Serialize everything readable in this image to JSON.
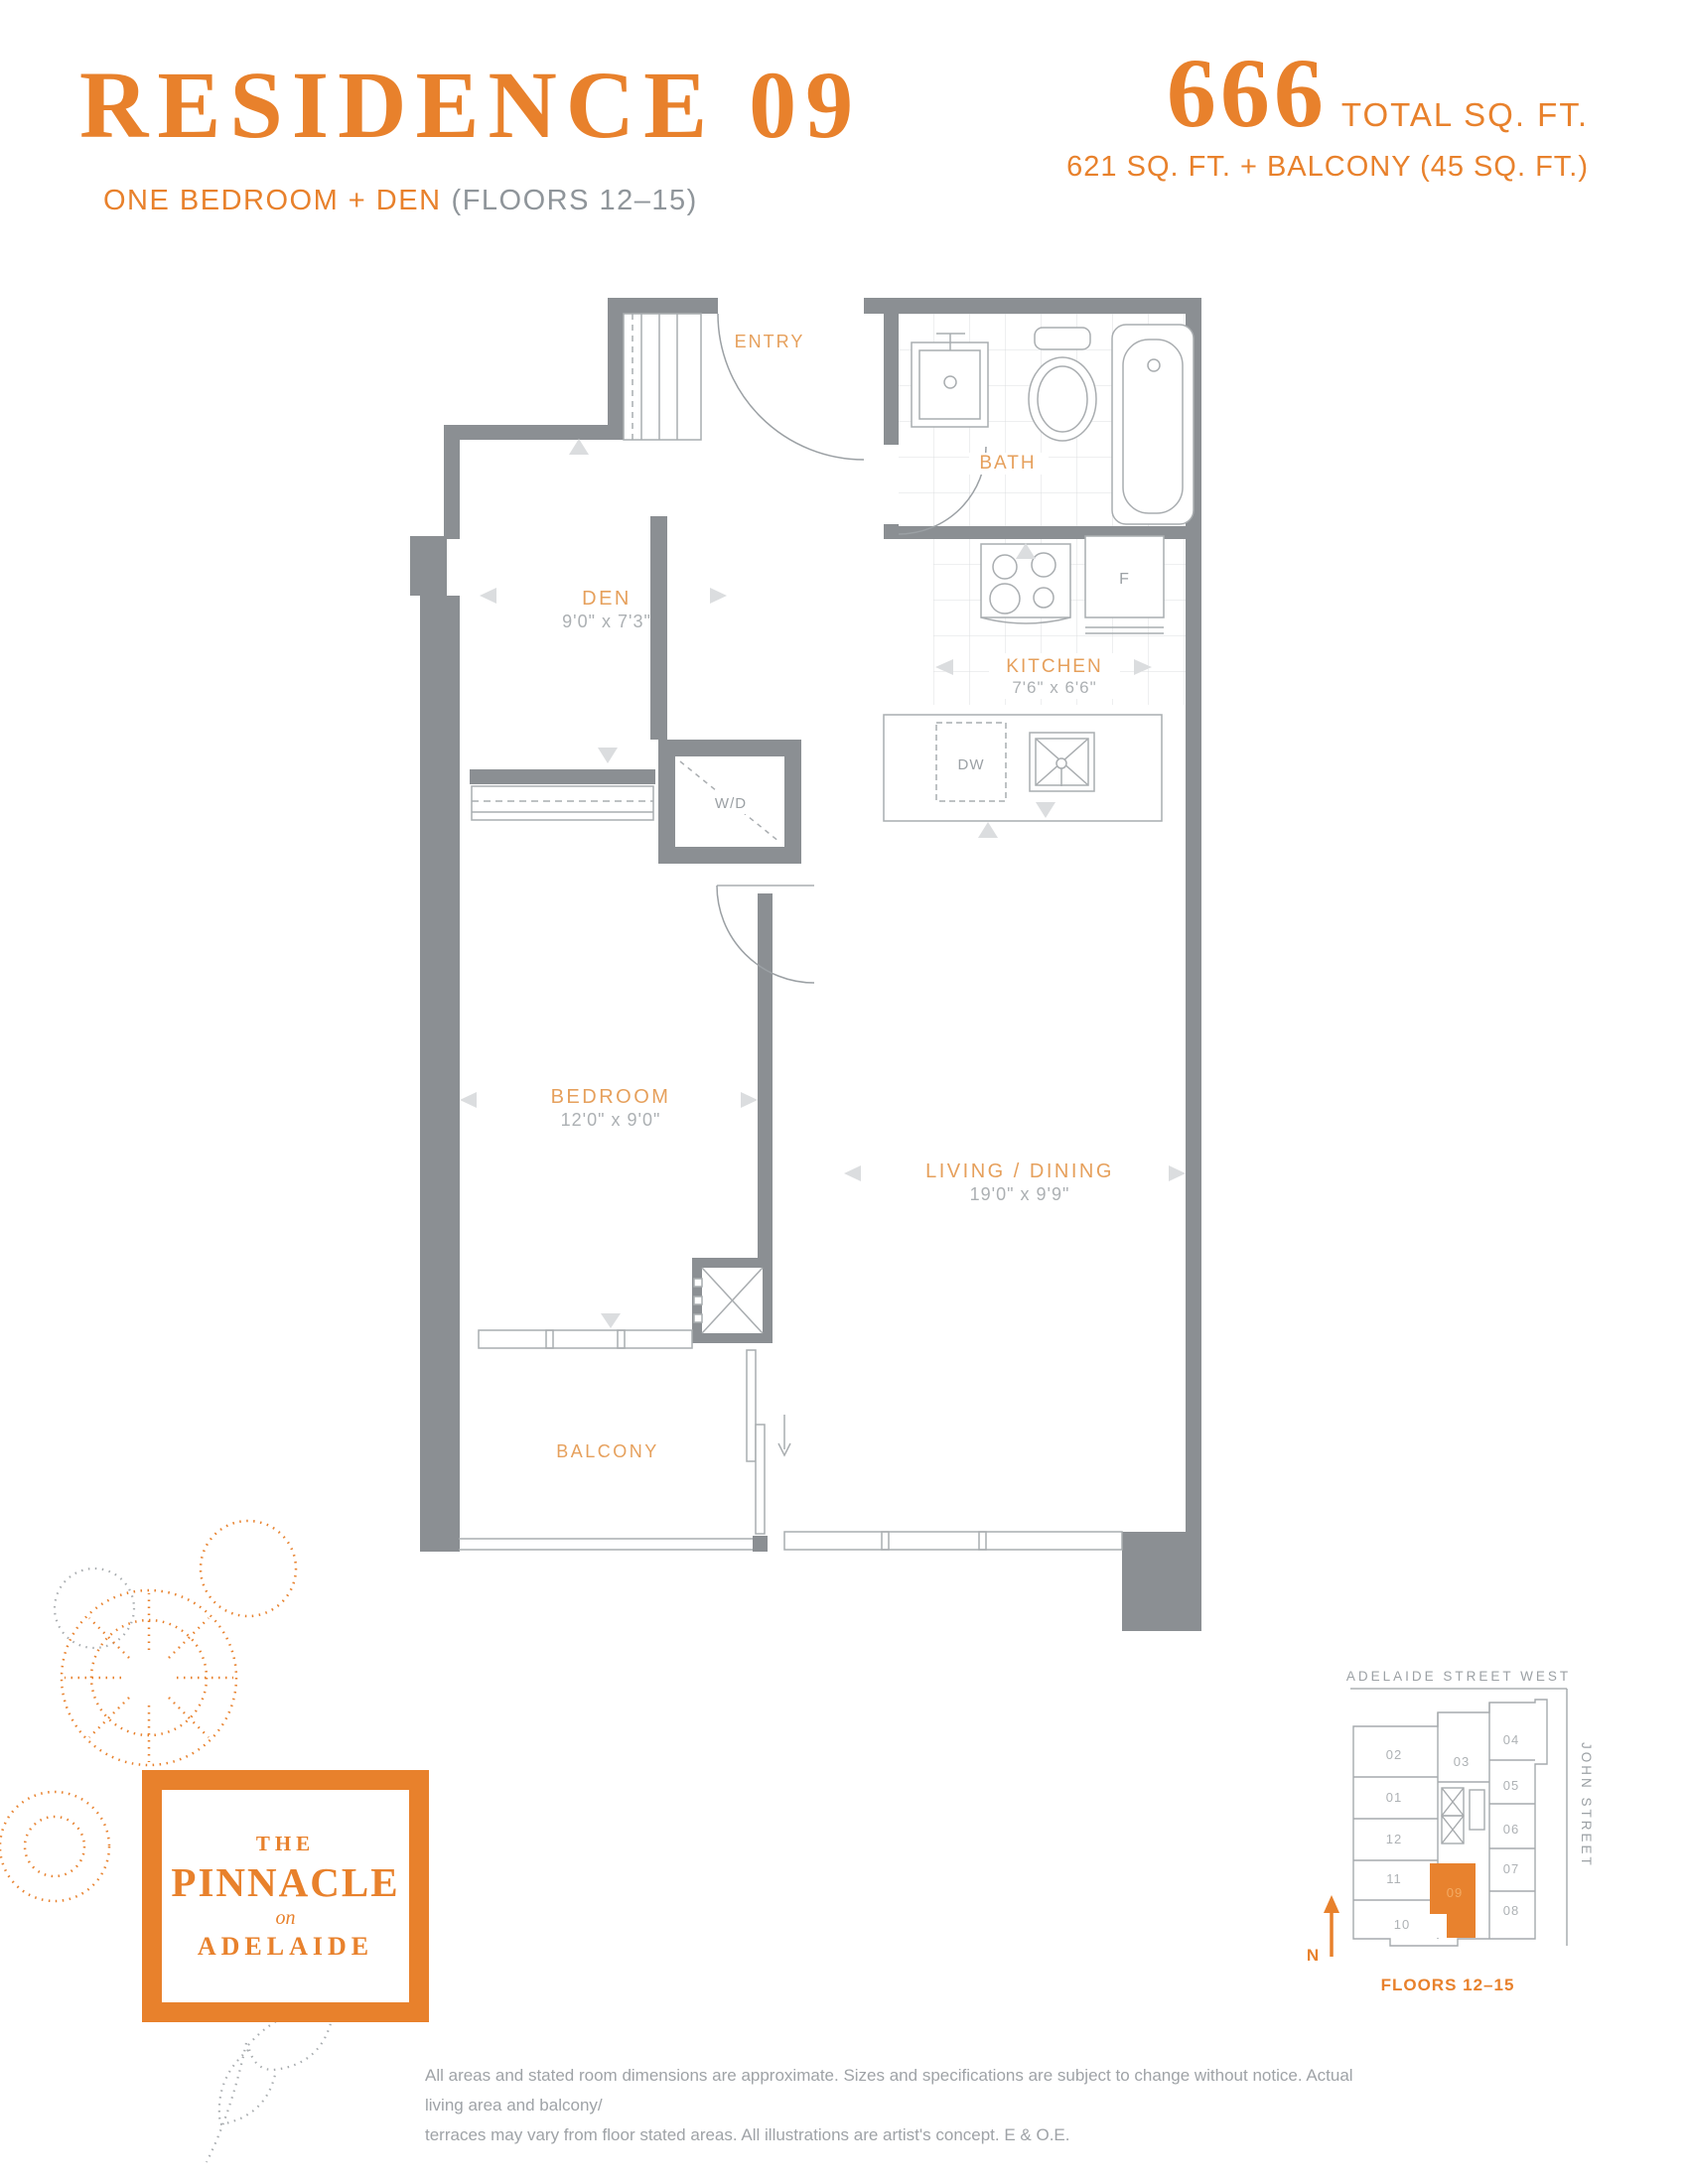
{
  "header": {
    "title": "RESIDENCE 09",
    "subtitle_highlight": "ONE BEDROOM + DEN",
    "subtitle_muted": "(FLOORS 12–15)",
    "total_sqft": "666",
    "total_sqft_label": "TOTAL SQ. FT.",
    "area_breakdown": "621 SQ. FT. + BALCONY (45 SQ. FT.)"
  },
  "floorplan": {
    "entry": {
      "label": "ENTRY"
    },
    "bath": {
      "label": "BATH"
    },
    "den": {
      "label": "DEN",
      "dims": "9'0\" x 7'3\""
    },
    "kitchen": {
      "label": "KITCHEN",
      "dims": "7'6\" x 6'6\""
    },
    "bedroom": {
      "label": "BEDROOM",
      "dims": "12'0\" x 9'0\""
    },
    "living_dining": {
      "label": "LIVING / DINING",
      "dims": "19'0\" x 9'9\""
    },
    "balcony": {
      "label": "BALCONY"
    },
    "appliances": {
      "washer_dryer": "W/D",
      "dishwasher": "DW",
      "fridge": "F"
    }
  },
  "keyplan": {
    "street_top": "ADELAIDE STREET WEST",
    "street_right": "JOHN STREET",
    "north": "N",
    "floors": "FLOORS 12–15",
    "highlighted_unit": "09",
    "units": [
      "02",
      "03",
      "04",
      "01",
      "05",
      "12",
      "06",
      "11",
      "07",
      "10",
      "08"
    ]
  },
  "logo": {
    "word_the": "THE",
    "word_name": "PINNACLE",
    "word_on": "on",
    "word_place": "ADELAIDE"
  },
  "disclaimer": {
    "line1": "All areas and stated room dimensions are approximate. Sizes and specifications are subject to change without notice. Actual living area and balcony/",
    "line2": "terraces may vary from floor stated areas. All illustrations are artist's concept. E & O.E."
  },
  "colors": {
    "accent": "#E8812C",
    "room_label": "#E6A05C",
    "wall": "#8B8F93",
    "dim_text": "#ACB0B3",
    "muted_text": "#9CA1A5"
  }
}
